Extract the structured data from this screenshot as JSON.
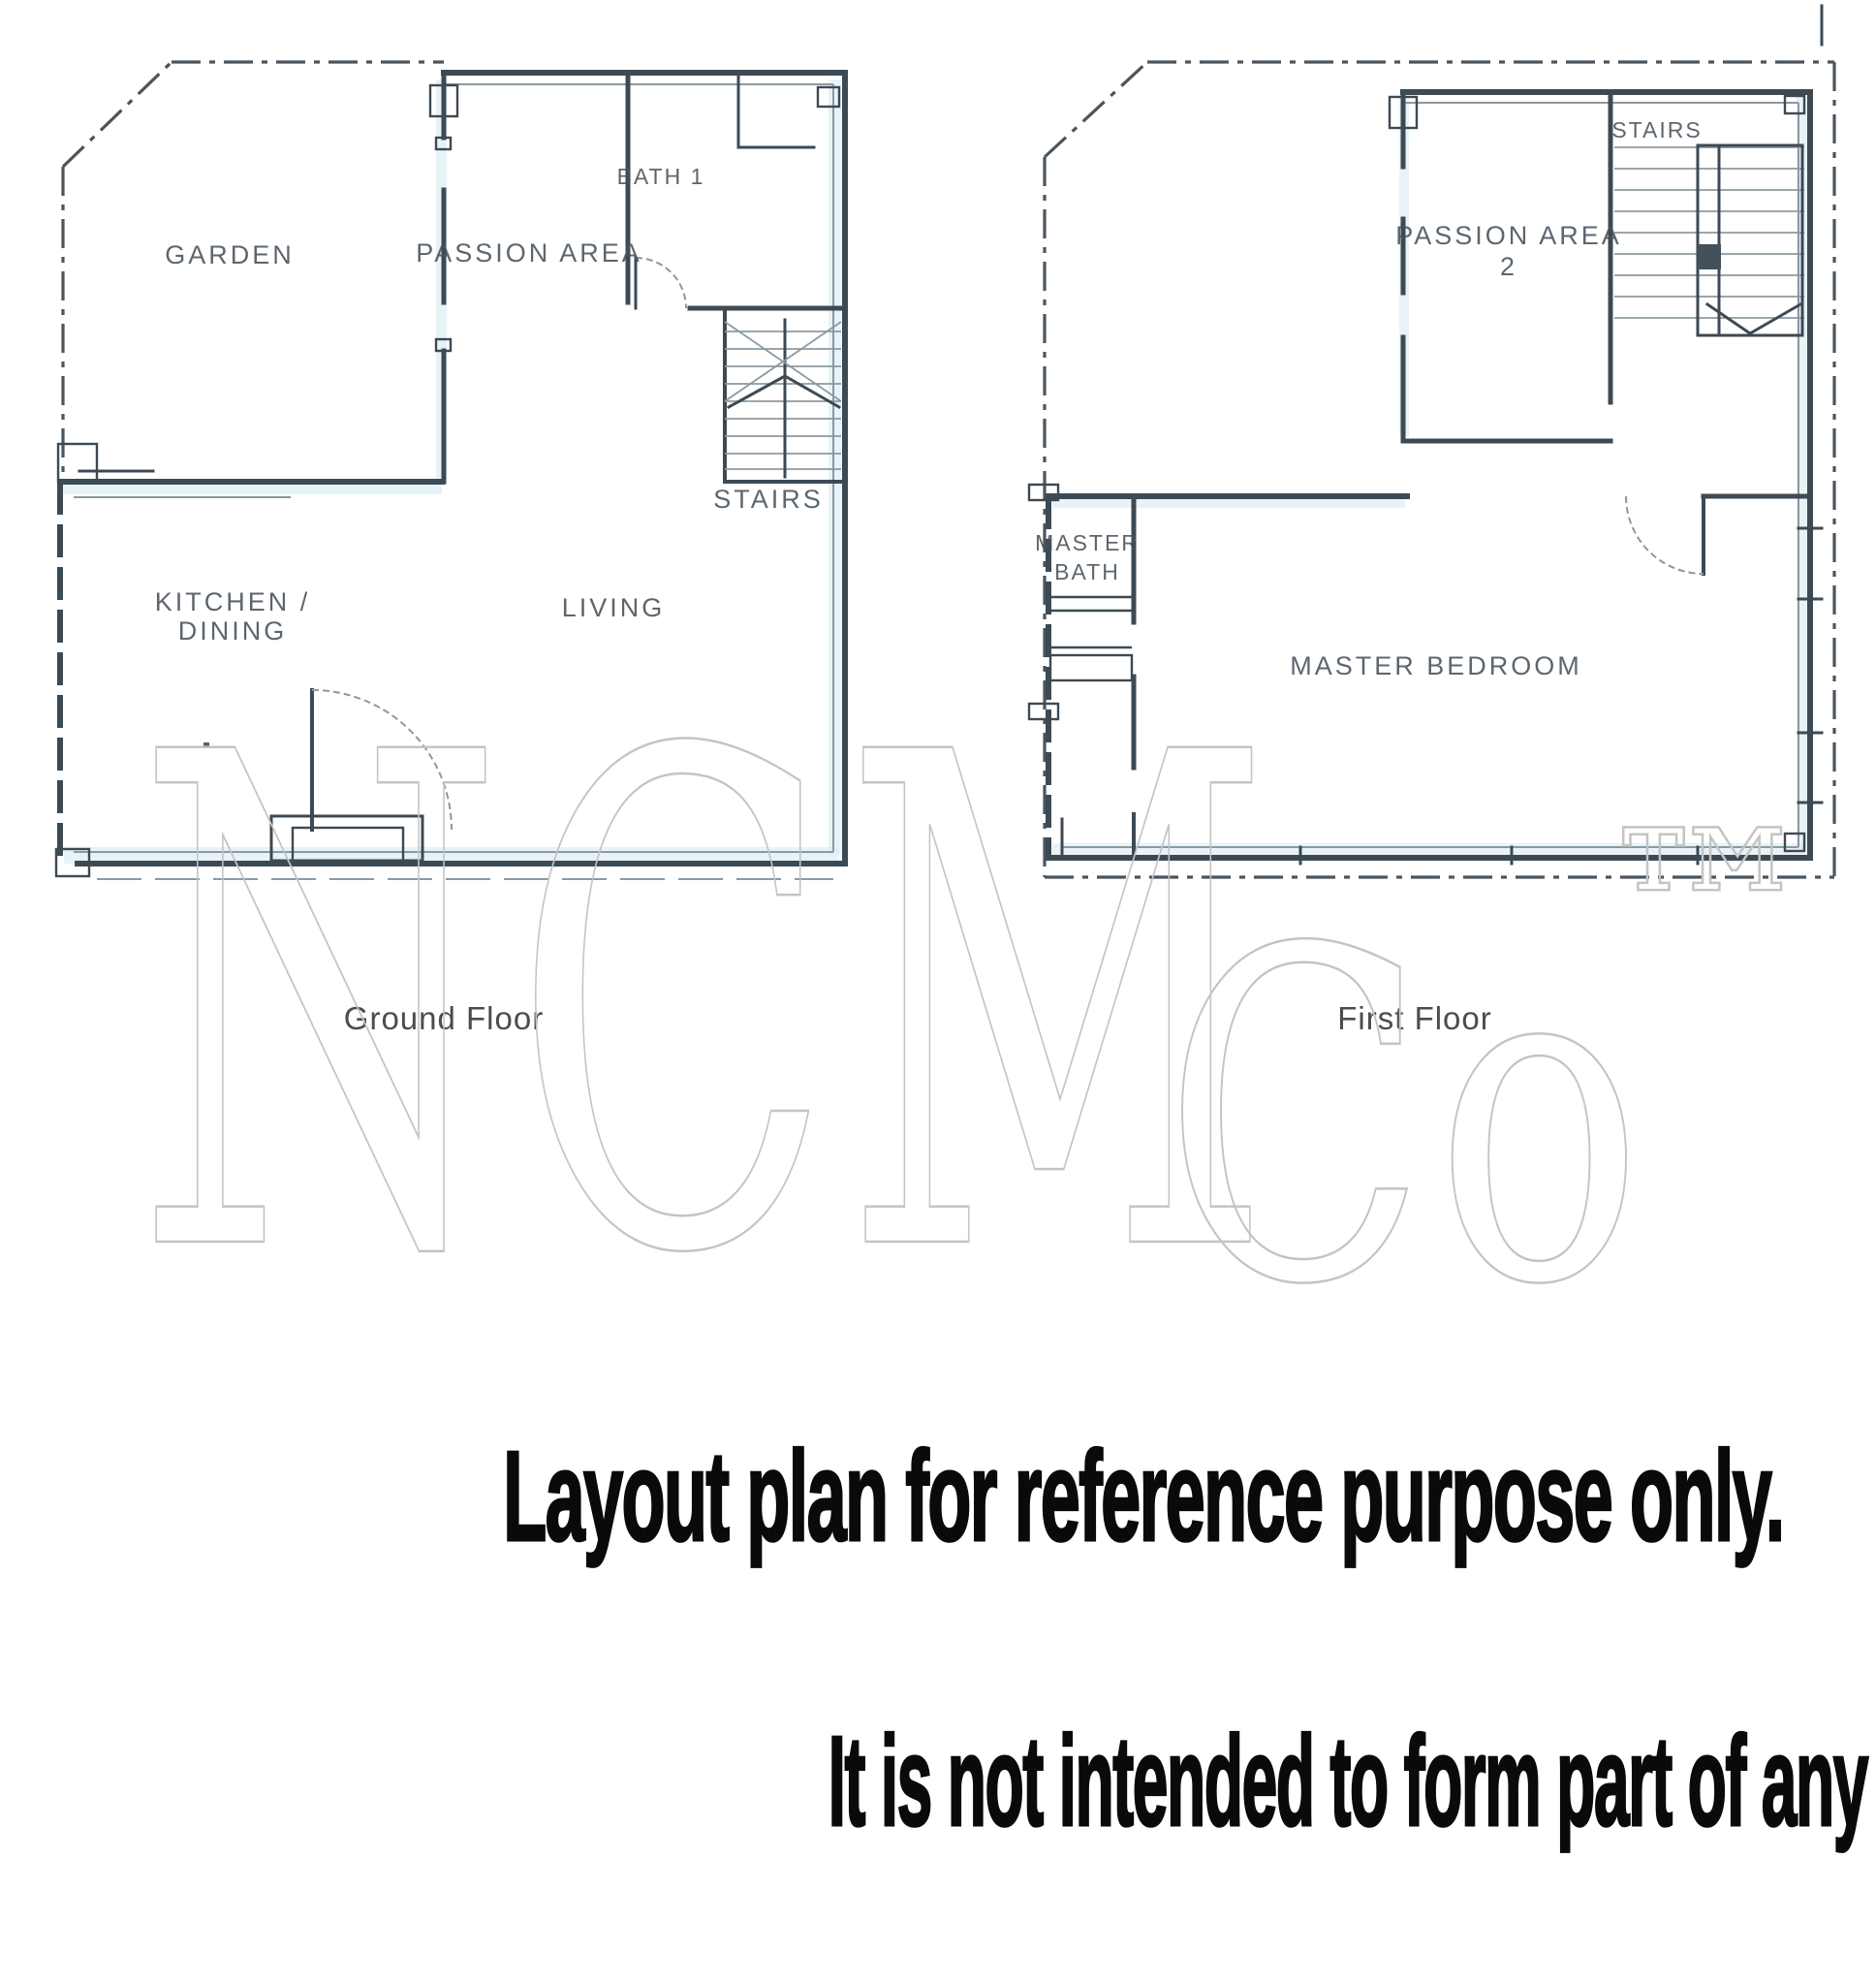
{
  "watermark": {
    "part1": "NCM",
    "part2": "Co",
    "trademark": "™"
  },
  "plans": [
    {
      "caption": "Ground Floor",
      "rooms": {
        "garden": "GARDEN",
        "passion_area": "PASSION AREA",
        "bath1": "BATH 1",
        "stairs": "STAIRS",
        "living": "LIVING",
        "kitchen_line1": "KITCHEN /",
        "kitchen_line2": "DINING"
      }
    },
    {
      "caption": "First Floor",
      "rooms": {
        "passion_area_line1": "PASSION AREA",
        "passion_area_line2": "2",
        "stairs": "STAIRS",
        "master_bath_line1": "MASTER",
        "master_bath_line2": "BATH",
        "master_bedroom": "MASTER BEDROOM"
      }
    }
  ],
  "disclaimer": {
    "line1": "Layout plan for reference purpose only.",
    "line2": "It is not intended to form part of any contract or warranty."
  },
  "colors": {
    "wall": "#3d4a54",
    "wall-light": "#8b99a2",
    "boundary": "#4a555e",
    "tint": "#d6eaf0",
    "label": "#46525c",
    "caption": "#3d3d3d",
    "watermark": "#c4c4c4",
    "disclaimer-text": "#0a0a0a"
  }
}
